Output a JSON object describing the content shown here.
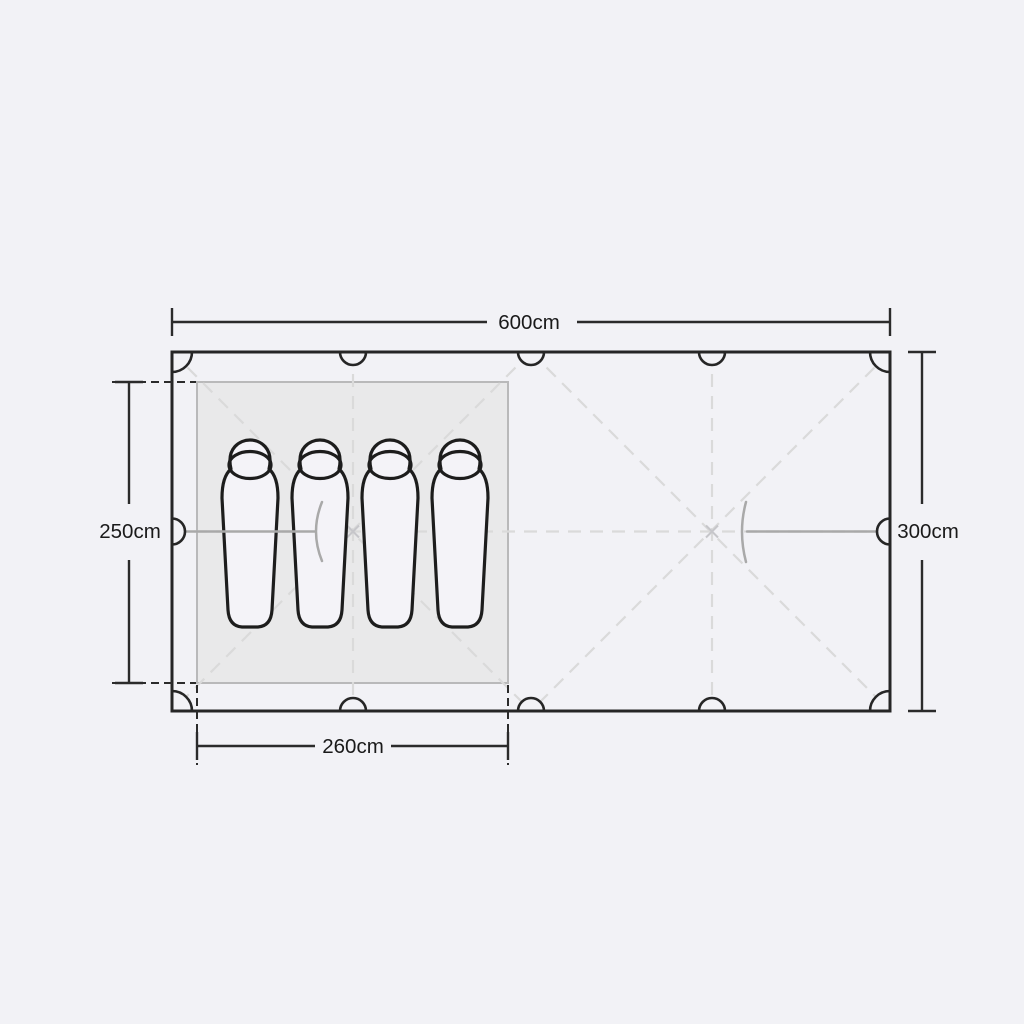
{
  "diagram": {
    "title": "tent-floorplan",
    "dimensions": {
      "total_width": {
        "label": "600cm",
        "edge": "top"
      },
      "total_depth": {
        "label": "300cm",
        "edge": "right"
      },
      "bedroom_depth": {
        "label": "250cm",
        "edge": "left"
      },
      "bedroom_width": {
        "label": "260cm",
        "edge": "bottom"
      }
    },
    "sleeping_bags": {
      "count": 4
    },
    "colors": {
      "background": "#f2f2f6",
      "tent_outline": "#262626",
      "dimension_line": "#2b2b2b",
      "bedroom_fill": "#e9e9ea",
      "bedroom_border": "#b9b9ba",
      "guide_dash": "#dadada",
      "center_mark": "#c6c6ca",
      "door_line": "#a9a9a9",
      "sleeping_bag_outline": "#1d1d1d",
      "sleeping_bag_fill": "#f4f3f8",
      "label_text": "#1a1a1a"
    }
  }
}
